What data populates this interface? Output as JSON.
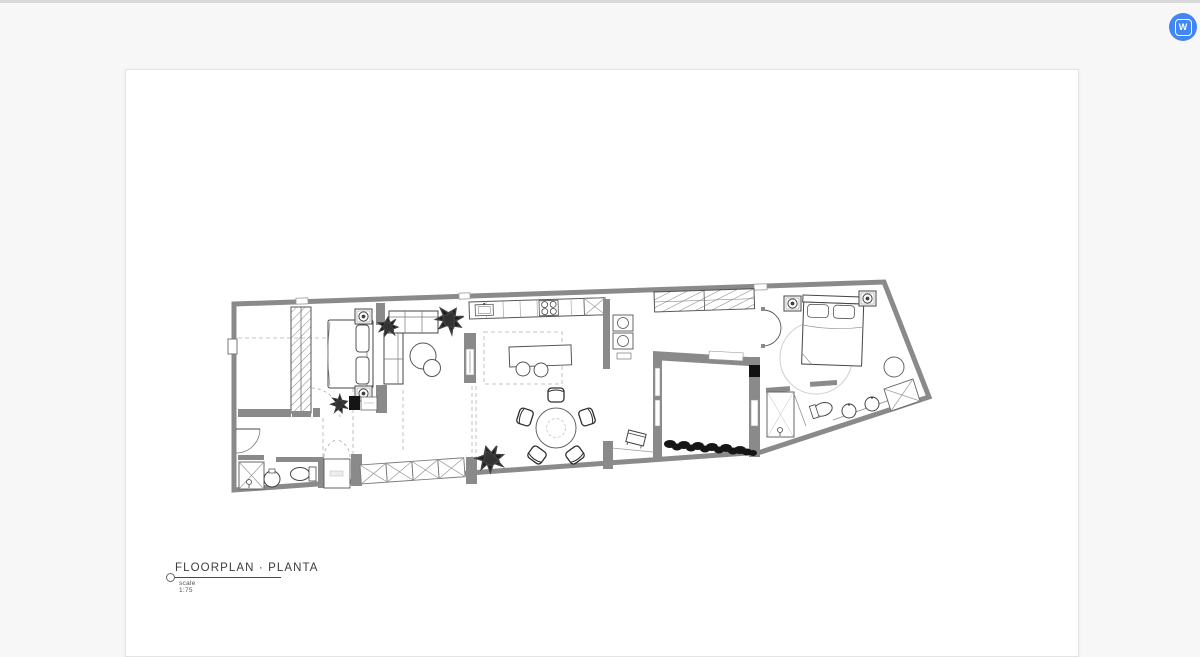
{
  "badge": {
    "letter": "W",
    "color": "#4285f4"
  },
  "drawing": {
    "title": "FLOORPLAN · PLANTA",
    "scale_note": "scale 1:75",
    "colors": {
      "wall": "#8a8a8a",
      "line": "#3f3f3f",
      "dash": "#b3b3b3",
      "plant": "#1c1c1c",
      "rug": "#cfcfcf"
    }
  }
}
